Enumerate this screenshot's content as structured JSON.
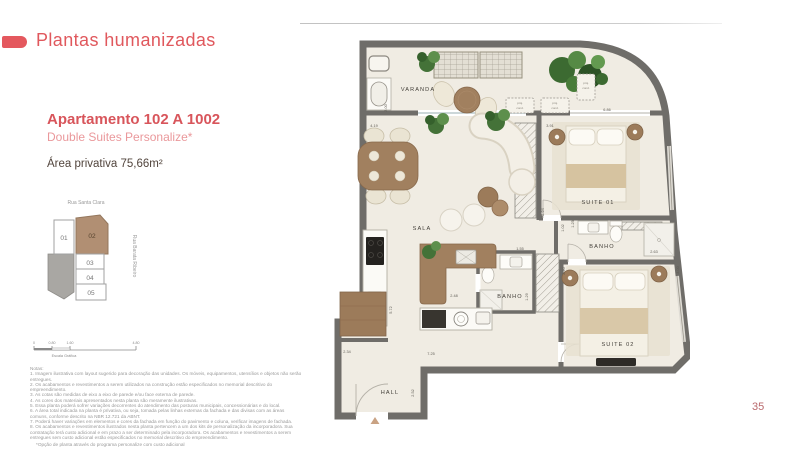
{
  "page": {
    "number": "35"
  },
  "header": {
    "title": "Plantas humanizadas"
  },
  "apartment": {
    "name": "Apartamento 102 A 1002",
    "variant": "Double Suites Personalize*",
    "area": "Área privativa 75,66m²"
  },
  "keyplan": {
    "street_top": "Rua Santa Clara",
    "street_right": "Rua Barata Ribeiro",
    "units": [
      "01",
      "02",
      "03",
      "04",
      "05"
    ],
    "highlighted_unit": "02"
  },
  "scalebar": {
    "labels": [
      "0",
      "0.80",
      "1.60",
      "4.80"
    ],
    "caption": "Escala Gráfica"
  },
  "notes": {
    "title": "Notas:",
    "items": [
      "1. Imagem ilustrativa com layout sugerido para decoração das unidades. Os móveis, equipamentos, utensílios e objetos não serão entregues.",
      "2. Os acabamentos e revestimentos a serem utilizados na construção estão especificados no memorial descritivo do empreendimento.",
      "3. As cotas são medidas de eixo a eixo de parede e/ou face externa de parede.",
      "4. As cores dos materiais apresentados nesta planta são meramente ilustrativas.",
      "5. Essa planta poderá sofrer variações decorrentes do atendimento das posturas municipais, concessionárias e do local.",
      "6. A área total indicada na planta é privativa, ou seja, tomada pelas linhas externas da fachada e das divisas com as áreas comuns, conforme descrito na NBR 12.721 da ABNT.",
      "7. Poderá haver variações em elementos e cores da fachada em função do pavimento e coluna, verificar imagens de fachada.",
      "8. Os acabamentos e revestimentos ilustrados nesta planta pertencem a um dos kits de personalização da incorporadora. Sua contratação terá custo adicional e em prazo a ser determinado pela incorporadora. Os acabamentos e revestimentos a serem entregues sem custo adicional estão especificados no memorial descritivo do empreendimento."
    ],
    "footnote": "*Opção de planta através do programa personalize com custo adicional"
  },
  "floorplan": {
    "rooms": {
      "varanda": "VARANDA",
      "sala": "SALA",
      "suite1": "SUITE 01",
      "banho1": "BANHO",
      "banho2": "BANHO",
      "suite2": "SUITE 02",
      "hall": "HALL"
    },
    "proj_cond_1": "proj.",
    "proj_cond_2": "cond.",
    "dims": {
      "varanda_depth": "2.00",
      "varanda_length": "6.86",
      "sala_width": "4.19",
      "suite1_width": "3.91",
      "divider": "2.94",
      "banho1_a": "1.25",
      "banho1_b": "1.02",
      "banho1_width": "2.63",
      "suite2_height": "3.00",
      "closet": "2.90",
      "banho2_width": "1.55",
      "banho2_depth": "1.29",
      "kitchen_pass": "2.48",
      "kitchen_length": "5.72",
      "hall_top": "7.25",
      "hall_left": "2.34",
      "hall_right": "2.52"
    }
  },
  "colors": {
    "accent": "#e4585e",
    "wall": "#6f6d69",
    "highlight_tan": "#b18f73"
  }
}
